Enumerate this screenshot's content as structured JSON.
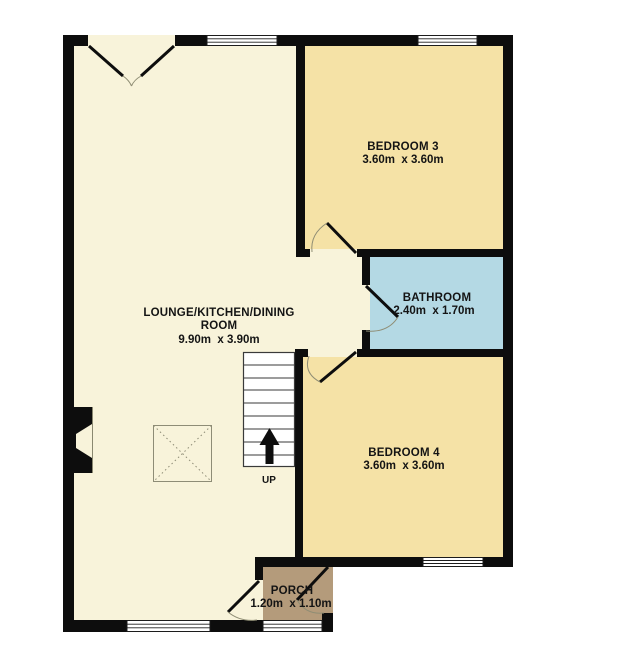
{
  "plan_title": "Ground floor plan",
  "colors": {
    "background": "#ffffff",
    "wall": "#0d0d0d",
    "lounge": "#f8f3da",
    "bedroom": "#f5e2a6",
    "bathroom": "#b4d9e4",
    "porch": "#b49b7b",
    "text": "#141414"
  },
  "rooms": {
    "lounge": {
      "name_line1": "LOUNGE/KITCHEN/DINING",
      "name_line2": "ROOM",
      "dims": "9.90m  x 3.90m"
    },
    "bedroom3": {
      "name": "BEDROOM 3",
      "dims": "3.60m  x 3.60m"
    },
    "bathroom": {
      "name": "BATHROOM",
      "dims": "2.40m  x 1.70m"
    },
    "bedroom4": {
      "name": "BEDROOM 4",
      "dims": "3.60m  x 3.60m"
    },
    "porch": {
      "name": "PORCH",
      "dims": "1.20m  x 1.10m"
    }
  },
  "stairs": {
    "label": "UP"
  }
}
